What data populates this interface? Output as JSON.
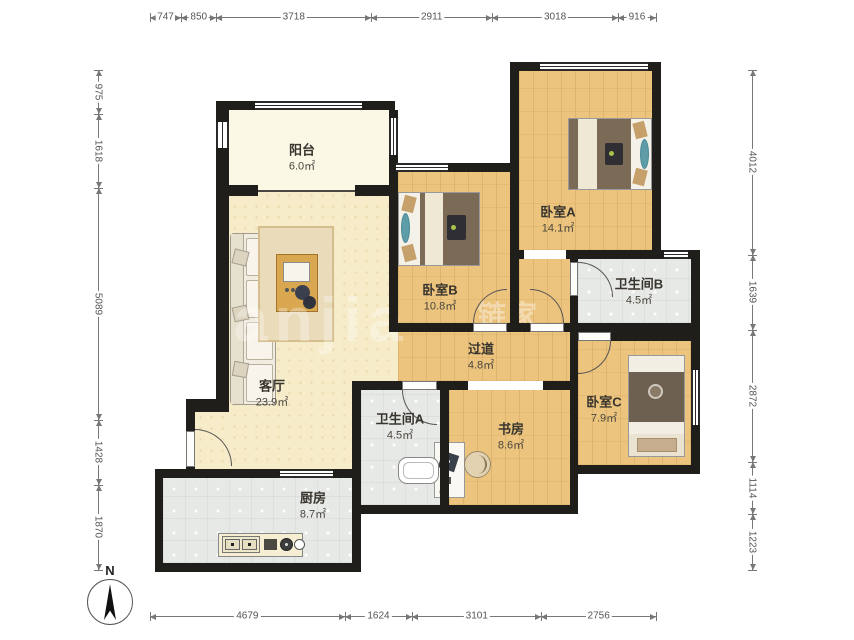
{
  "compass": {
    "label": "N"
  },
  "watermark": {
    "latin": "lianjia",
    "cn": "链家"
  },
  "rooms": {
    "balcony": {
      "name": "阳台",
      "area": "6.0㎡"
    },
    "living": {
      "name": "客厅",
      "area": "23.9㎡"
    },
    "bedroomA": {
      "name": "卧室A",
      "area": "14.1㎡"
    },
    "bedroomB": {
      "name": "卧室B",
      "area": "10.8㎡"
    },
    "bedroomC": {
      "name": "卧室C",
      "area": "7.9㎡"
    },
    "bathroomA": {
      "name": "卫生间A",
      "area": "4.5㎡"
    },
    "bathroomB": {
      "name": "卫生间B",
      "area": "4.5㎡"
    },
    "hallway": {
      "name": "过道",
      "area": "4.8㎡"
    },
    "study": {
      "name": "书房",
      "area": "8.6㎡"
    },
    "kitchen": {
      "name": "厨房",
      "area": "8.7㎡"
    }
  },
  "dimensions": {
    "top": [
      "747",
      "850",
      "3718",
      "2911",
      "3018",
      "916"
    ],
    "bottom": [
      "4679",
      "1624",
      "3101",
      "2756"
    ],
    "left": [
      "975",
      "1618",
      "5089",
      "1428",
      "1870"
    ],
    "right": [
      "4012",
      "1639",
      "2872",
      "1114",
      "1223"
    ]
  },
  "colors": {
    "wall": "#201E1B",
    "wood_floor": "#ECC47E",
    "living_floor": "#F7ECCA",
    "balcony_floor": "#FBF8E5",
    "tile_floor": "#E7E9E6"
  }
}
